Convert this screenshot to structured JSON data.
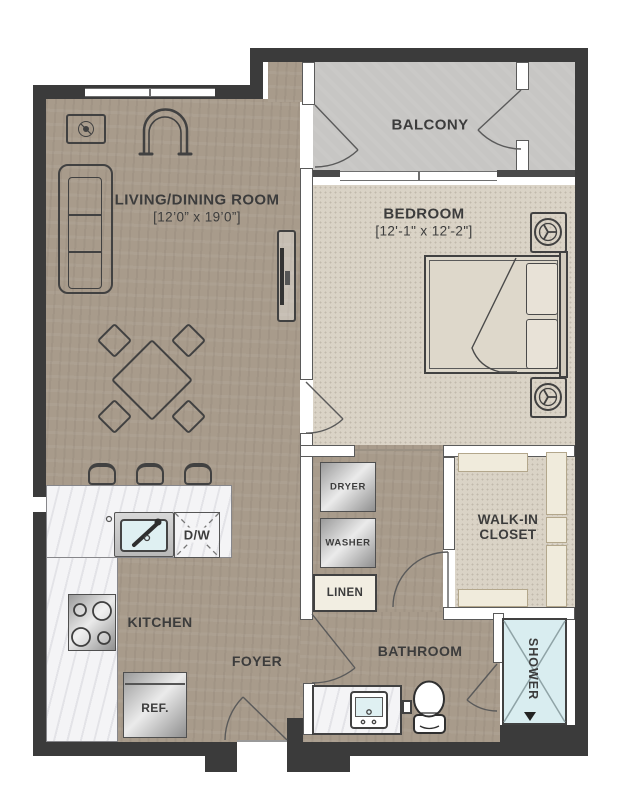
{
  "rooms": {
    "living": {
      "name": "LIVING/DINING ROOM",
      "dims": "[12’0” x 19’0”]"
    },
    "bedroom": {
      "name": "BEDROOM",
      "dims": "[12'-1\" x 12'-2\"]"
    },
    "balcony": {
      "name": "BALCONY"
    },
    "kitchen": {
      "name": "KITCHEN"
    },
    "foyer": {
      "name": "FOYER"
    },
    "bathroom": {
      "name": "BATHROOM"
    },
    "closet": {
      "line1": "WALK-IN",
      "line2": "CLOSET"
    },
    "shower": {
      "name": "SHOWER"
    },
    "linen": {
      "name": "LINEN"
    }
  },
  "appliances": {
    "dryer": "DRYER",
    "washer": "WASHER",
    "dishwasher": "D/W",
    "refrigerator": "REF."
  },
  "colors": {
    "wall": "#3b3b3b",
    "wood": "#a89b8b",
    "carpet": "#dad3c6",
    "balcony": "#c7c6c4",
    "marble": "#f4f4f6",
    "shower": "#d9edf0",
    "shelf": "#f0ebdc",
    "line": "#414141",
    "text": "#3c3c3c",
    "basin": "#dff0f2"
  }
}
